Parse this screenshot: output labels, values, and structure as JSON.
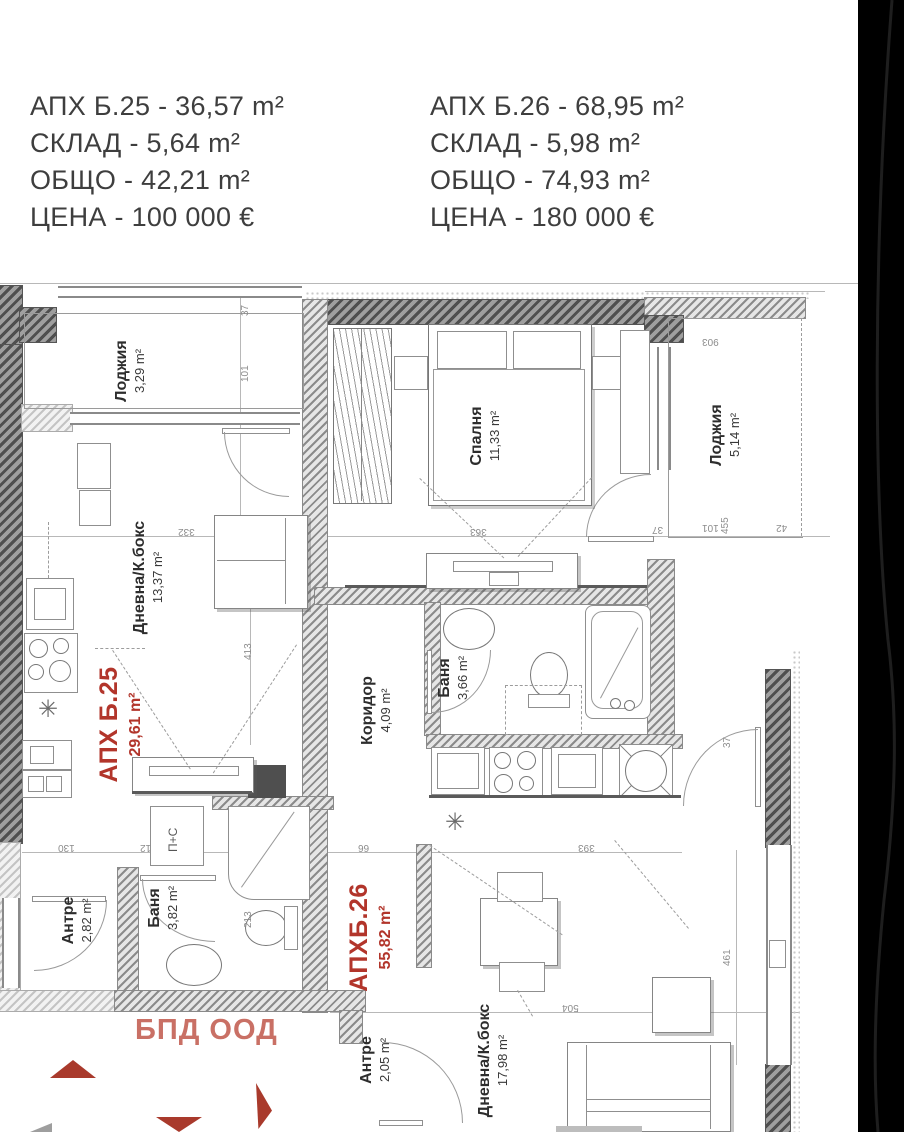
{
  "listings": [
    {
      "lines": [
        "АПХ Б.25 - 36,57 m²",
        "СКЛАД - 5,64 m²",
        "ОБЩО - 42,21 m²",
        "ЦЕНА - 100 000 €"
      ]
    },
    {
      "lines": [
        "АПХ Б.26 - 68,95 m²",
        "СКЛАД - 5,98 m²",
        "ОБЩО - 74,93 m²",
        "ЦЕНА - 180 000 €"
      ]
    }
  ],
  "apartments": {
    "b25": {
      "label": "АПХ Б.25",
      "area": "29,61 m²"
    },
    "b26": {
      "label": "АПХБ.26",
      "area": "55,82 m²"
    }
  },
  "rooms": {
    "loggia25": {
      "name": "Лоджия",
      "area": "3,29 m²"
    },
    "living25": {
      "name": "Дневна/К.бокс",
      "area": "13,37 m²"
    },
    "bedroom": {
      "name": "Спалня",
      "area": "11,33 m²"
    },
    "loggia26": {
      "name": "Лоджия",
      "area": "5,14 m²"
    },
    "corridor": {
      "name": "Коридор",
      "area": "4,09 m²"
    },
    "bath26": {
      "name": "Баня",
      "area": "3,66 m²"
    },
    "entry25": {
      "name": "Антре",
      "area": "2,82 m²"
    },
    "bath25": {
      "name": "Баня",
      "area": "3,82 m²"
    },
    "entry26": {
      "name": "Антре",
      "area": "2,05 m²"
    },
    "living26": {
      "name": "Дневна/К.бокс",
      "area": "17,98 m²"
    }
  },
  "labels": {
    "logo": "БПД ООД",
    "washer": "П+С",
    "boiler_symbol": "✳"
  },
  "dimensions": [
    "37",
    "101",
    "332",
    "363",
    "413",
    "130",
    "12",
    "66",
    "393",
    "903",
    "455",
    "101",
    "42",
    "37",
    "37",
    "213",
    "461",
    "504"
  ],
  "colors": {
    "accent_red": "#b2352b",
    "logo_salmon": "#c97065",
    "wall_dark": "#4f4f4f",
    "line_gray": "#9a9a9a"
  }
}
